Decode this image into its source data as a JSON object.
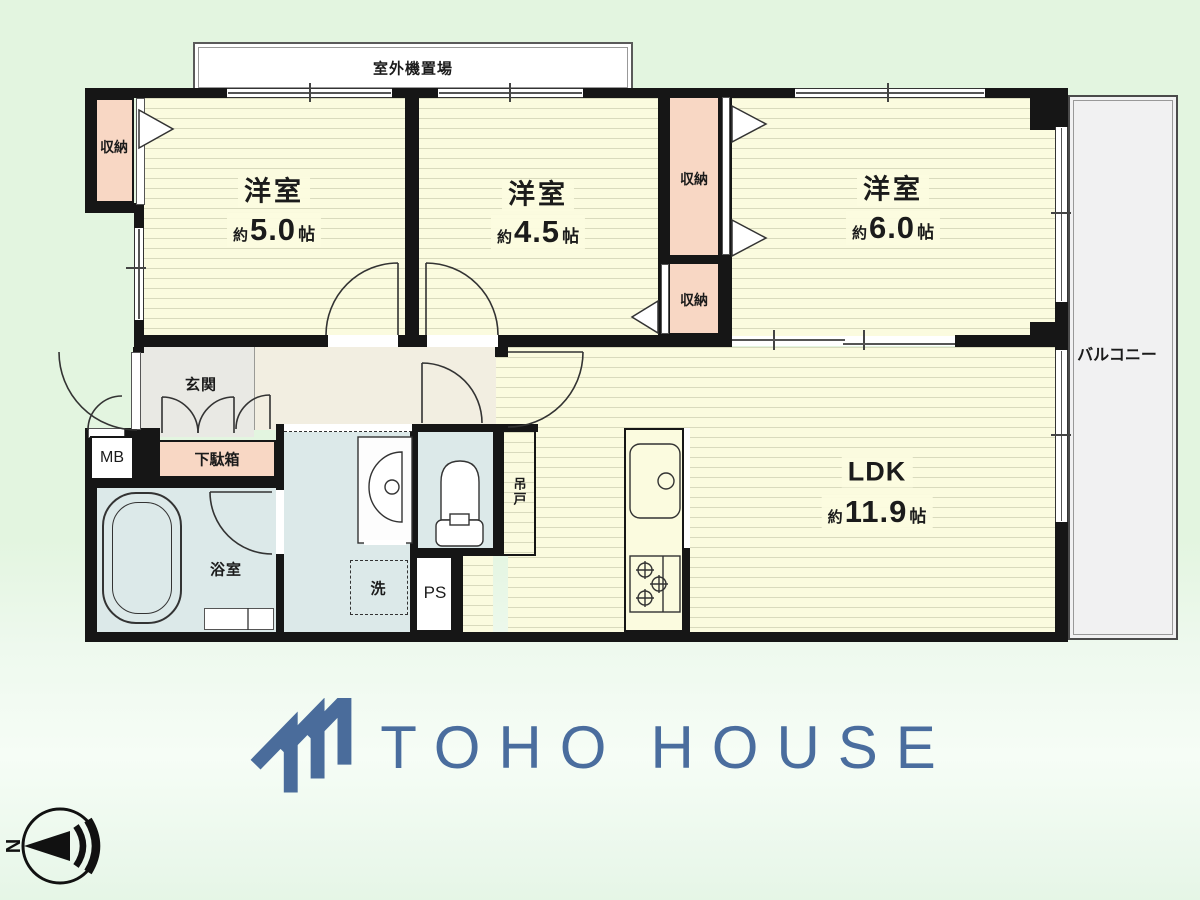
{
  "colors": {
    "background_green": "#e3f5e0",
    "floor_cream": "#fbfbdf",
    "floor_stripe": "#d9dabd",
    "closet_pink": "#f8d7c4",
    "wet_blue": "#dce9e9",
    "entrance_gray": "#e9e9e4",
    "hall_beige": "#f2eee1",
    "balcony_gray": "#f1f1f2",
    "wall_black": "#161616",
    "logo_blue": "#4a6d9e"
  },
  "rooms": {
    "western1": {
      "name": "洋室",
      "approx": "約",
      "size": "5.0",
      "unit": "帖"
    },
    "western2": {
      "name": "洋室",
      "approx": "約",
      "size": "4.5",
      "unit": "帖"
    },
    "western3": {
      "name": "洋室",
      "approx": "約",
      "size": "6.0",
      "unit": "帖"
    },
    "ldk": {
      "name": "LDK",
      "approx": "約",
      "size": "11.9",
      "unit": "帖"
    }
  },
  "labels": {
    "outdoor_unit_area": "室外機置場",
    "balcony": "バルコニー",
    "closet_top_left": "収納",
    "closet_upper": "収納",
    "closet_lower": "収納",
    "entrance": "玄関",
    "shoe_cabinet": "下駄箱",
    "meter_box": "MB",
    "bathroom": "浴室",
    "laundry": "洗",
    "pipe_space": "PS",
    "hanging_cupboard": "吊戸"
  },
  "icons": {
    "logo_mark": "toho-house-chevrons",
    "compass": "north-arrow-compass"
  },
  "compass": {
    "north": "N"
  },
  "logo": {
    "word1": "TOHO",
    "word2": "HOUSE"
  }
}
